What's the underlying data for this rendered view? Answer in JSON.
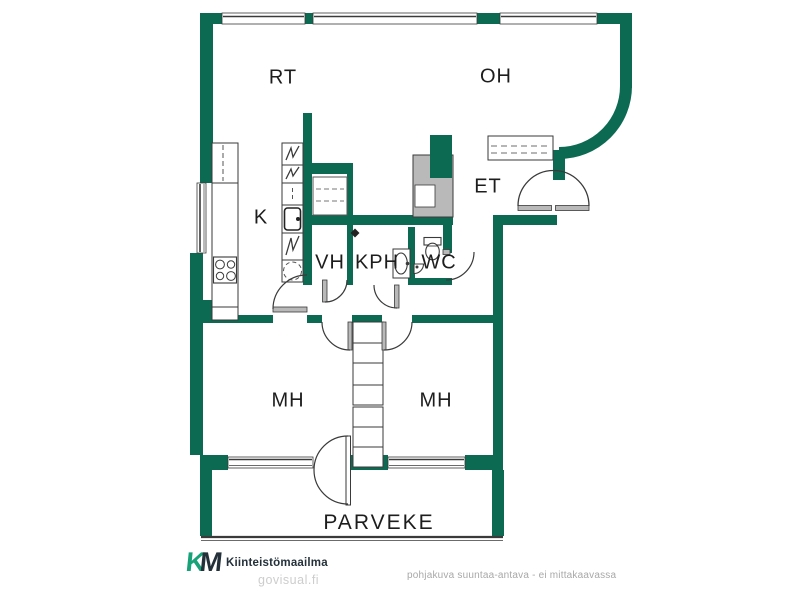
{
  "plan": {
    "rooms": {
      "rt": "RT",
      "oh": "OH",
      "k": "K",
      "et": "ET",
      "vh": "VH",
      "kph": "KPH",
      "wc": "WC",
      "mh_left": "MH",
      "mh_right": "MH",
      "parveke": "PARVEKE"
    },
    "colors": {
      "wall_green": "#0d6a52",
      "fixture_gray": "#b9b9b9",
      "line_dark": "#3a3a3a"
    }
  },
  "footer": {
    "logo_k": "K",
    "logo_m": "M",
    "brand": "Kiinteistömaailma",
    "brand_logo_color": "#17a278",
    "watermark": "govisual.fi",
    "disclaimer": "pohjakuva suuntaa-antava - ei mittakaavassa"
  }
}
